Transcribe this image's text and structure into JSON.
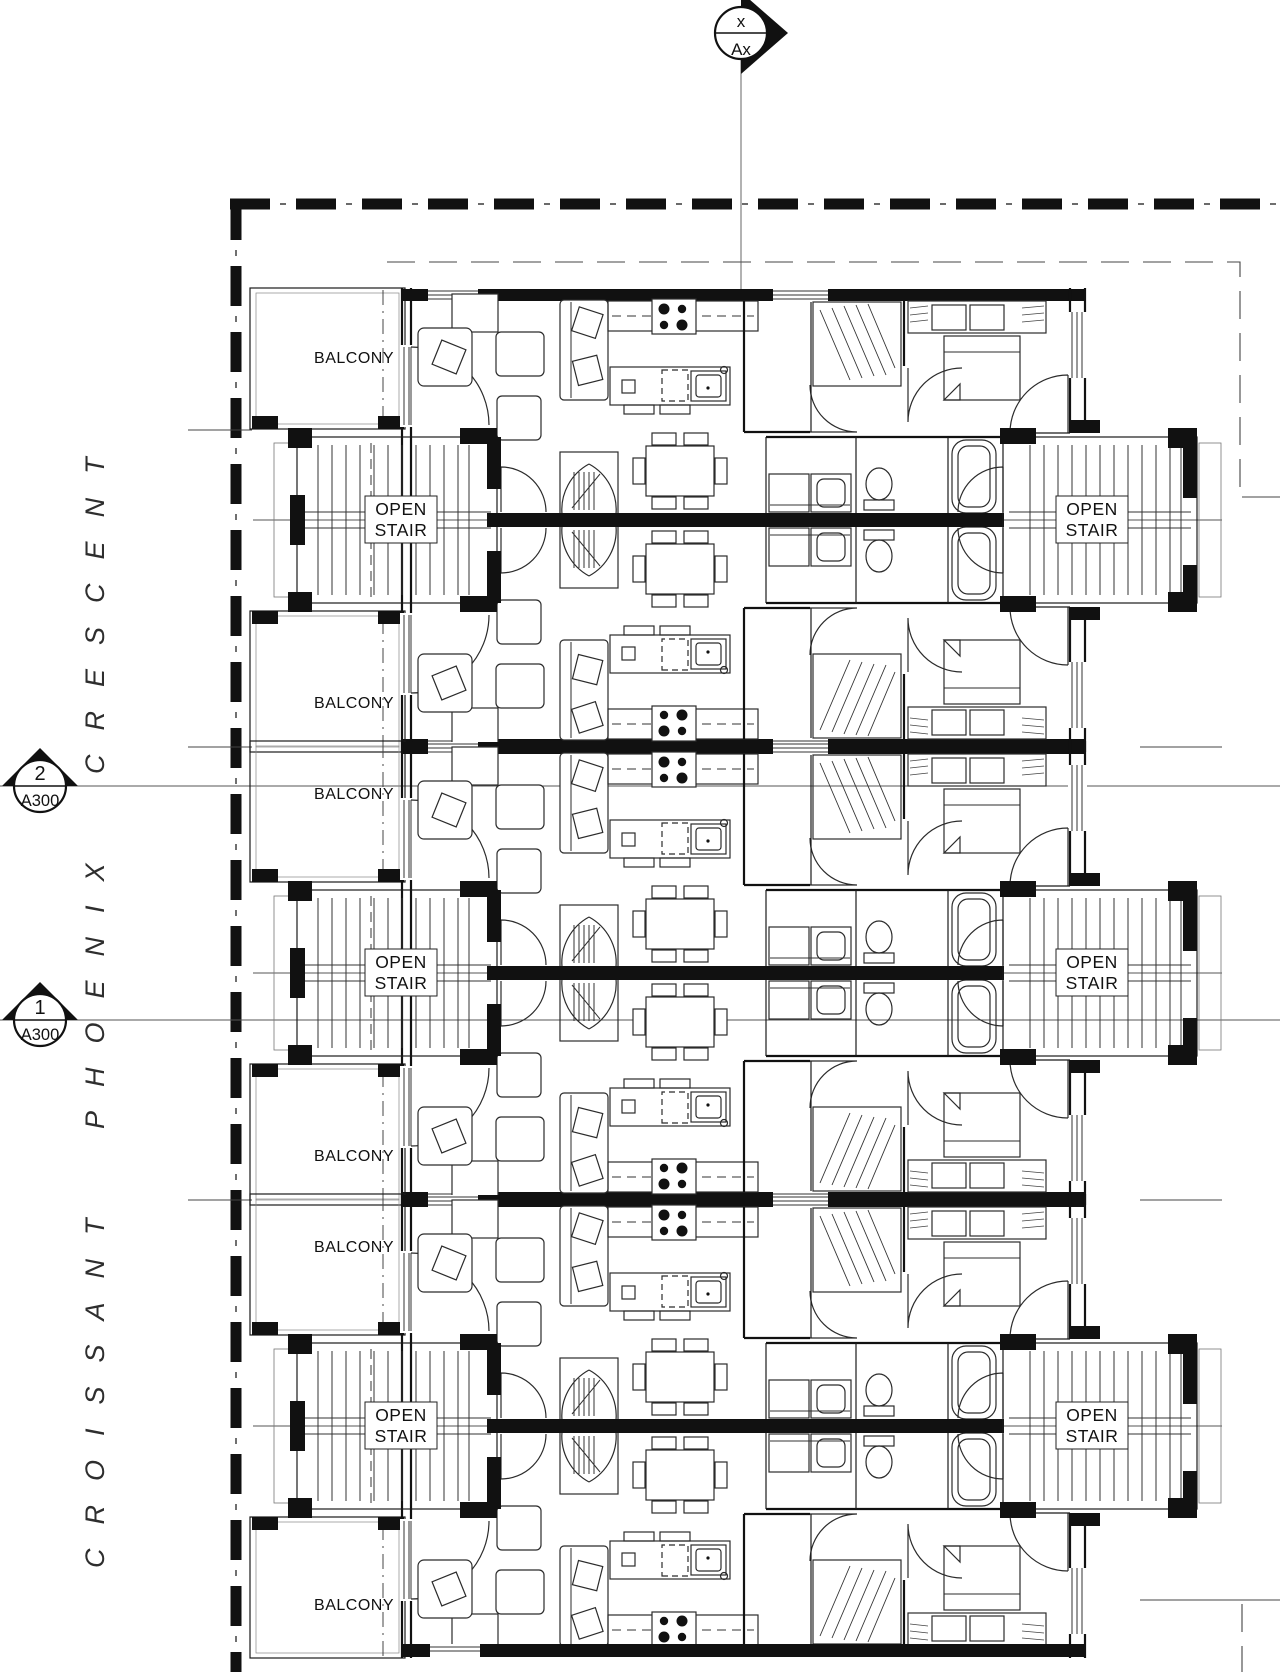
{
  "drawing": {
    "street": {
      "name": "CROISSANT PHOENIX CRESCENT"
    },
    "labels": {
      "balcony": "BALCONY",
      "stair_line1": "OPEN",
      "stair_line2": "STAIR"
    },
    "grid_marker": {
      "top": "x",
      "bottom": "Ax"
    },
    "section_markers": [
      {
        "number": "2",
        "sheet": "A300"
      },
      {
        "number": "1",
        "sheet": "A300"
      }
    ]
  }
}
